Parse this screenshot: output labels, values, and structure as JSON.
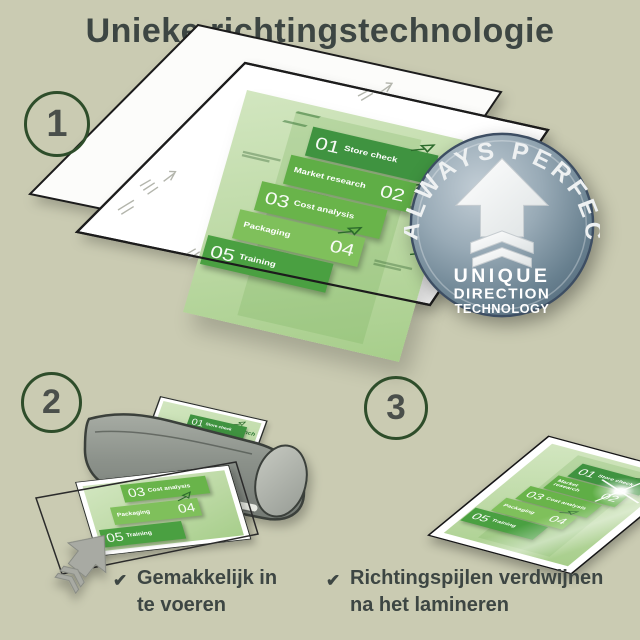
{
  "title": "Unieke richtingstechnologie",
  "steps": {
    "one": "1",
    "two": "2",
    "three": "3"
  },
  "badge": {
    "arc_text": "ALWAYS PERFECT!",
    "line1": "UNIQUE",
    "line2": "DIRECTION",
    "line3": "TECHNOLOGY",
    "arrow_icon": "up-arrow-with-chevrons"
  },
  "infographic": {
    "launch_label": "Launch",
    "blocks": [
      {
        "num": "01",
        "label": "Store check",
        "color": "#3f9340",
        "num_side": "left",
        "arrow": true
      },
      {
        "num": "02",
        "label": "Market research",
        "color": "#5fae46",
        "num_side": "right",
        "arrow": false
      },
      {
        "num": "03",
        "label": "Cost analysis",
        "color": "#69b44a",
        "num_side": "left",
        "arrow": false
      },
      {
        "num": "04",
        "label": "Packaging",
        "color": "#7fc05b",
        "num_side": "right",
        "arrow": true
      },
      {
        "num": "05",
        "label": "Training",
        "color": "#4aa041",
        "num_side": "left",
        "arrow": false
      }
    ]
  },
  "checks": [
    {
      "icon": "✔",
      "line1": "Gemakkelijk in",
      "line2": "te voeren"
    },
    {
      "icon": "✔",
      "line1": "Richtingspijlen verdwijnen",
      "line2": "na het lamineren"
    }
  ],
  "colors": {
    "background": "#cacbb2",
    "title_text": "#3d4643",
    "step_ring": "#2e4d2a",
    "step_number": "#4a4f4b",
    "check_text": "#3d4643",
    "badge_face": "#7d93a3",
    "badge_rim": "#3d4e63",
    "sheet_green": "#bcd9a4",
    "laminator_gray": "#8b918a",
    "feed_arrow_gray": "#a8aaa3"
  }
}
